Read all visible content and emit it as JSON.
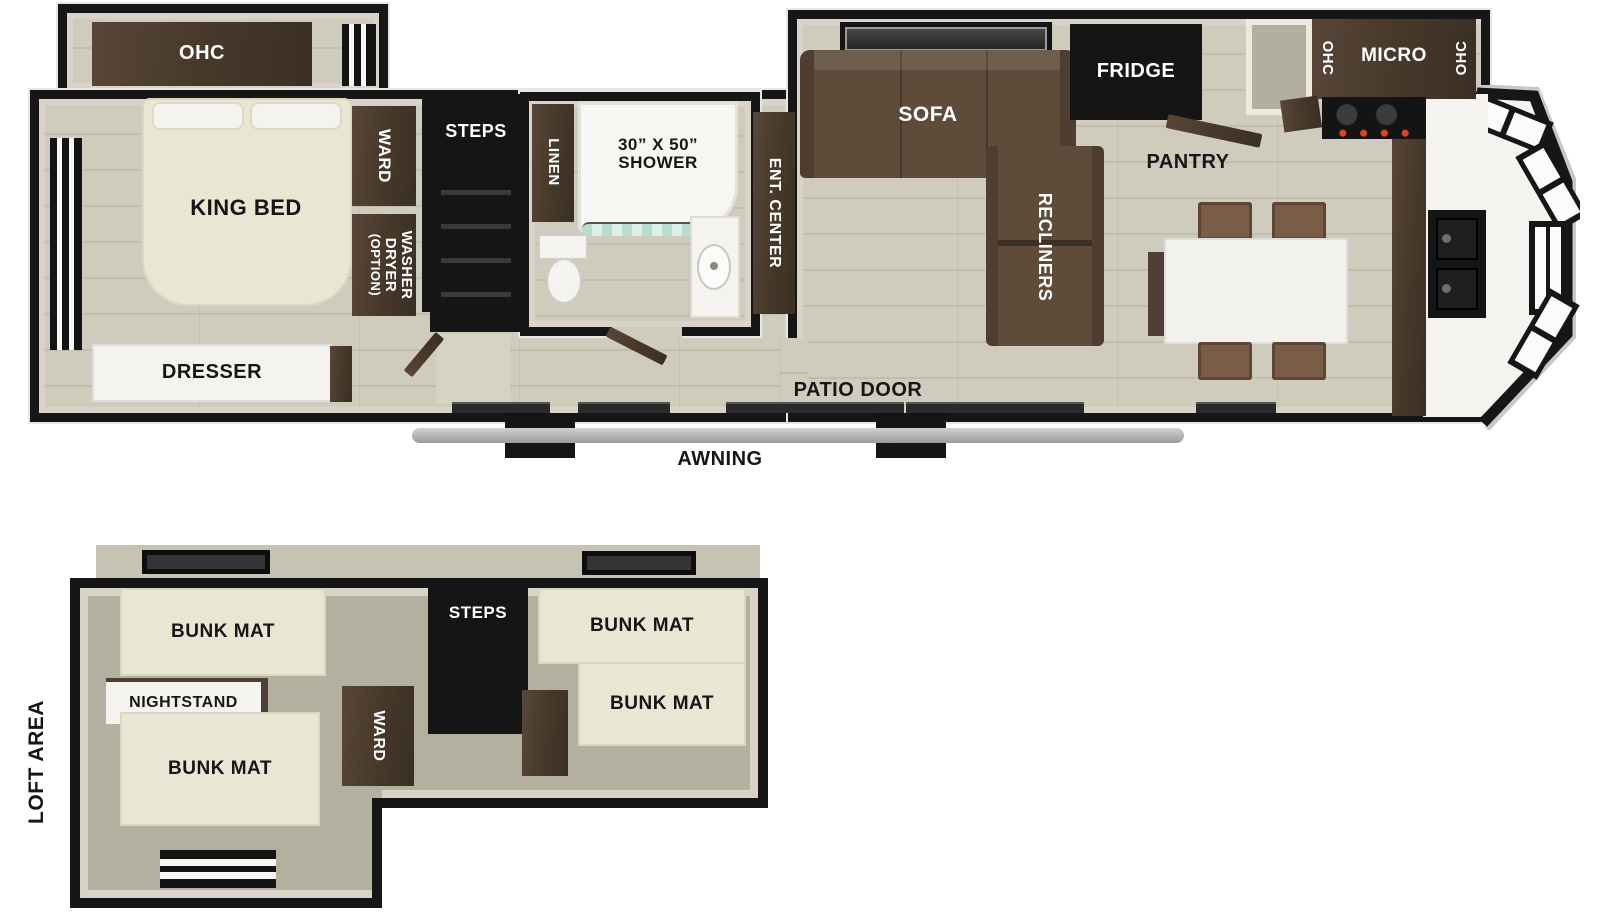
{
  "colors": {
    "outline": "#161616",
    "wall_lining": "#d9d4c7",
    "floor_wood": "#cbc7b7",
    "floor_loft": "#b4b09f",
    "cabinet_dark": "#463829",
    "sofa_brown": "#5f4b3a",
    "chair_brown": "#7a5d46",
    "mat_cream": "#e9e6d4",
    "curtain_teal": "#bfe0d2",
    "awning_gray": "#b8b8b8"
  },
  "main_floor": {
    "bedroom": {
      "ohc": "OHC",
      "king_bed": "KING BED",
      "ward": "WARD",
      "washer_line1": "WASHER",
      "washer_line2": "DRYER",
      "washer_line3": "(OPTION)",
      "dresser": "DRESSER"
    },
    "bath": {
      "steps": "STEPS",
      "linen": "LINEN",
      "shower_line1": "30” X 50”",
      "shower_line2": "SHOWER",
      "ent_center": "ENT. CENTER"
    },
    "living": {
      "sofa": "SOFA",
      "recliners": "RECLINERS",
      "fridge": "FRIDGE",
      "pantry": "PANTRY"
    },
    "kitchen": {
      "ohc_left": "OHC",
      "micro": "MICRO",
      "ohc_right": "OHC"
    },
    "patio_door": "PATIO DOOR",
    "awning": "AWNING"
  },
  "loft": {
    "area": "LOFT AREA",
    "bunk_mats": [
      "BUNK MAT",
      "BUNK MAT",
      "BUNK MAT",
      "BUNK MAT"
    ],
    "nightstand": "NIGHTSTAND",
    "ward": "WARD",
    "steps": "STEPS"
  }
}
